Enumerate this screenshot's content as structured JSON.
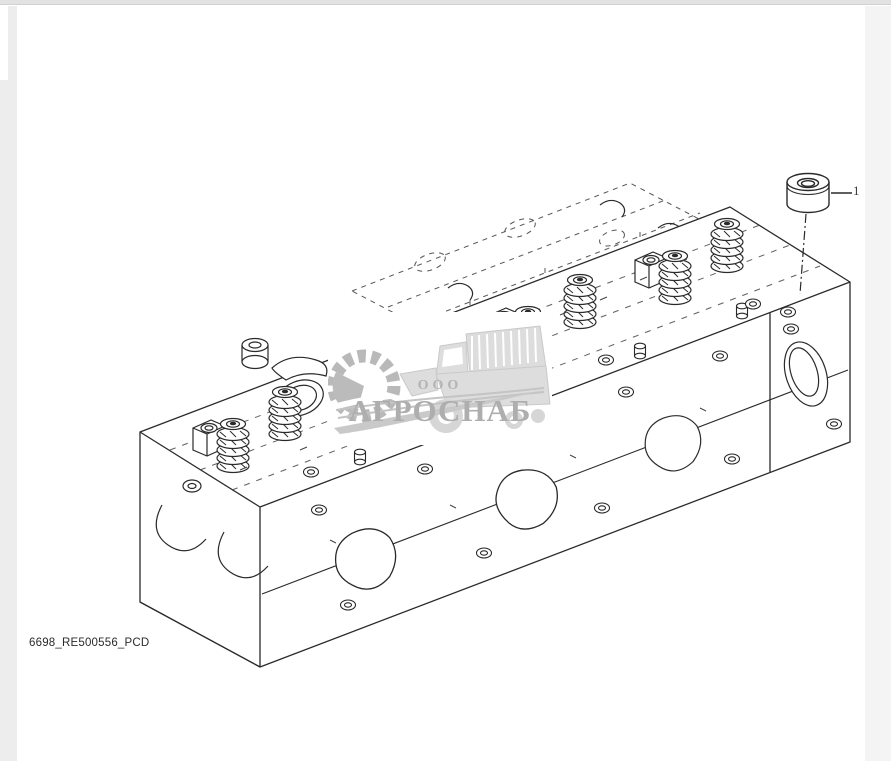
{
  "page": {
    "background": "#ffffff",
    "chrome": {
      "top_bar_color": "#e2e2e2",
      "left_strip_color": "#ededed",
      "right_strip_color": "#f4f4f4"
    }
  },
  "figure": {
    "caption": "6698_RE500556_PCD",
    "description": "Isometric exploded line drawing of a diesel engine cylinder head with valve springs and rocker pedestals",
    "line_color": "#2a2a2a",
    "hidden_line_color": "#3a3a3a",
    "callouts": [
      {
        "label": "1",
        "part_name": "cup-plug"
      }
    ]
  },
  "watermark": {
    "prefix": "ООО",
    "name": "АГРОСНАБ",
    "text_color": "#aeaeae",
    "art_color": "#c6c6c6",
    "fill_color": "#dddddd",
    "background": "#ffffff",
    "icons": [
      "gear-icon",
      "swoosh-icon",
      "combine-harvester-icon"
    ]
  }
}
